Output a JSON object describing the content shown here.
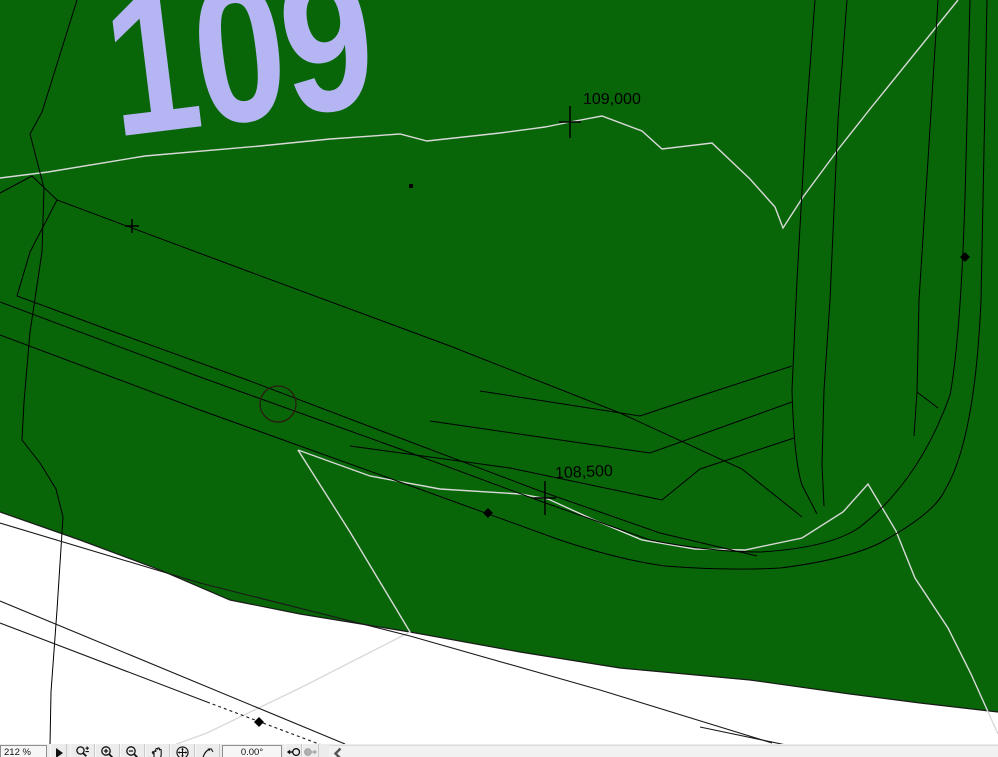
{
  "plan": {
    "zone_number": "109",
    "zone_color": "#b4b5f2",
    "terrain_fill_color": "#086608",
    "contour_color": "#d9d9d9",
    "elevation_labels": [
      {
        "text": "109,000"
      },
      {
        "text": "108,500"
      }
    ],
    "markers": {
      "cross_count": 3,
      "node_diamond_count": 3,
      "circle_marker": "tree-circle"
    }
  },
  "toolbar": {
    "zoom_percent": "212 %",
    "rotation_angle": "0.00°",
    "icons": [
      "flyout-arrow-icon",
      "zoom-options-icon",
      "zoom-in-icon",
      "zoom-out-icon",
      "pan-icon",
      "fit-in-window-icon",
      "rotate-view-icon",
      "previous-zoom-icon",
      "next-zoom-icon",
      "scroll-left-icon"
    ]
  }
}
